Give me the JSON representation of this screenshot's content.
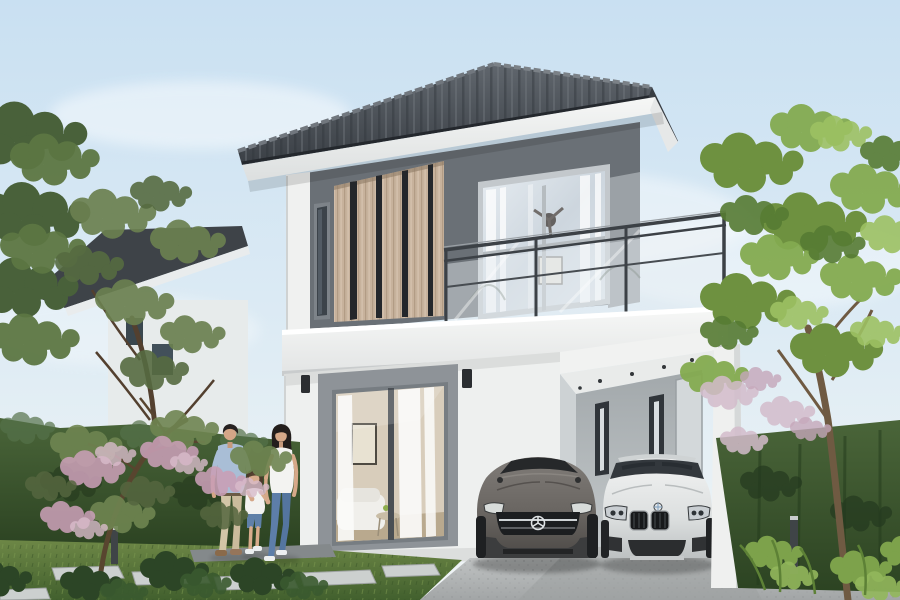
{
  "meta": {
    "alt": "Architectural rendering of a modern two-storey house with hipped grey tile roof, timber slat screen, glass balcony, carport with a grey sports coupe and a white saloon, and a family of three walking on a stepping-stone path through a garden",
    "width_px": 900,
    "height_px": 600
  },
  "scene": {
    "house": {
      "storeys": 2,
      "roof": "hipped dark grey concrete tile",
      "upper_facade": [
        "white corner pilaster",
        "dark grey panel with slit window",
        "timber slat screen",
        "grey wall with large sliding window and sheer curtains"
      ],
      "balcony": "steel frame with glass balustrade",
      "ground_floor": [
        "white render walls",
        "grey recessed sliding glass door showing living room",
        "two black wall sconces",
        "open carport with downlights and slit windows",
        "white square column"
      ]
    },
    "vehicles": [
      {
        "name": "grey sports coupe",
        "badge": "three-pointed star grille"
      },
      {
        "name": "white saloon",
        "badge": "twin-kidney grille with roundel"
      }
    ],
    "people": [
      {
        "role": "father",
        "clothing": "light blue shirt, beige trousers"
      },
      {
        "role": "daughter",
        "clothing": "white t-shirt, denim shorts, holding parents' hands"
      },
      {
        "role": "mother",
        "clothing": "white top, blue jeans"
      }
    ],
    "landscape": [
      "trimmed dark hedge",
      "lawn with stepping stones",
      "pink blossom trees",
      "large green trees left and right",
      "ferns",
      "two bollard lights",
      "concrete driveway",
      "neighbouring house roof behind trees"
    ]
  },
  "palette": {
    "sky-top": "#c9e0f2",
    "sky-bottom": "#f1f5f6",
    "roof-grey": "#454a50",
    "facade-grey": "#6a7076",
    "wall-light-grey": "#9ba1a6",
    "slat-wood": "#c7b29c",
    "wall-white": "#eff0ef",
    "railing-metal": "#3c4146",
    "glass": "#dde4ea",
    "lawn-green": "#5d7a3c",
    "hedge-green": "#3a5530",
    "foliage-green": "#7ca44b",
    "blossom-pink": "#c99fb6",
    "driveway-grey": "#b2b5b6",
    "coupe-grey": "#6b6864",
    "saloon-white": "#e9ebeb",
    "skin": "#d4a687",
    "shirt-blue": "#a9bed6",
    "denim-blue": "#5d7ea9",
    "khaki": "#d2c5a7"
  }
}
